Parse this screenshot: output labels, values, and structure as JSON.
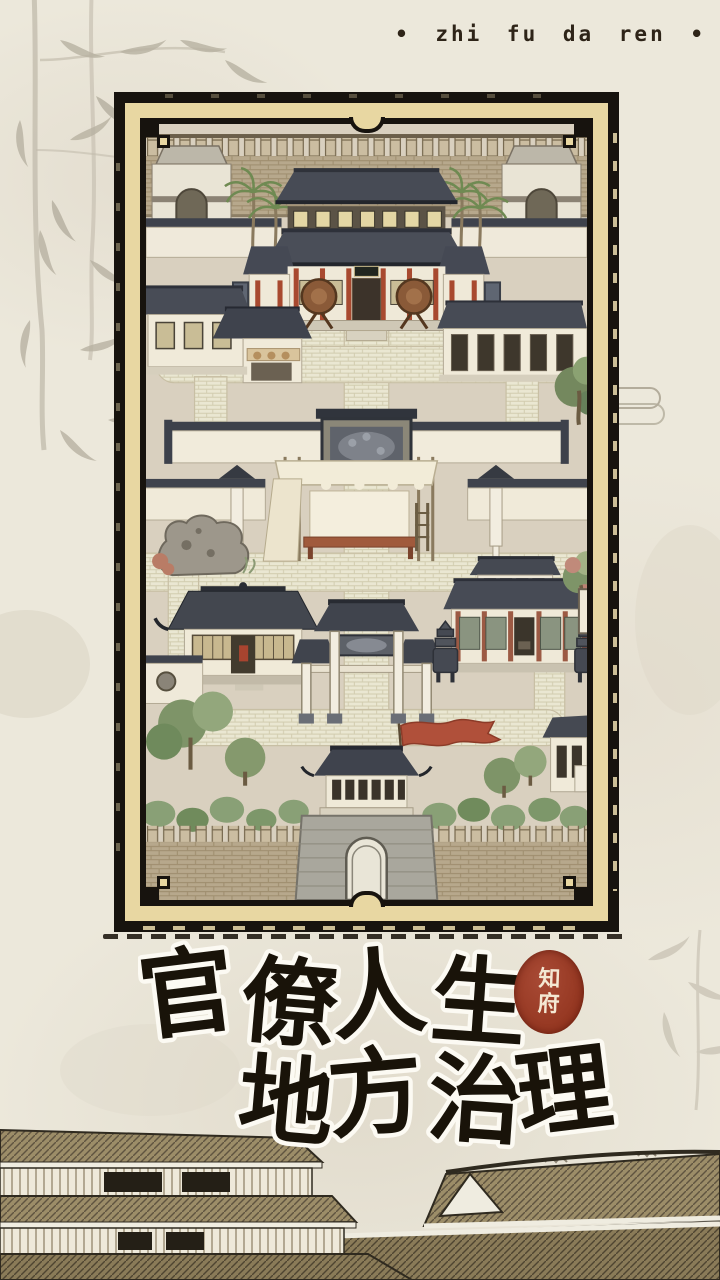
{
  "header": {
    "pinyin_title": "• zhi fu da ren •"
  },
  "board": {
    "frame": {
      "mat_color": "#e8d7a2",
      "border_color": "#17130e"
    },
    "map_features": [
      "north-city-wall",
      "watch-tower-left",
      "watch-tower-right",
      "main-yamen-hall",
      "ceremonial-drums",
      "palm-trees",
      "west-shop-row",
      "east-barracks",
      "carved-screen-wall",
      "canopy-stage",
      "garden-rockery",
      "west-pavilion",
      "memorial-archway",
      "east-hall",
      "incense-burners",
      "south-gate-tower",
      "red-banner",
      "south-city-wall",
      "courtyard-paths",
      "trees-and-shrubs"
    ]
  },
  "title": {
    "line1": "官僚人生",
    "line2": "地方治理",
    "seal": {
      "char1": "知",
      "char2": "府",
      "color": "#9c3c2b"
    }
  },
  "colors": {
    "background": "#ece8db",
    "ink": "#191309",
    "mat": "#e8d7a2",
    "seal_red": "#9c3c2b",
    "banner_red": "#b0503a"
  }
}
